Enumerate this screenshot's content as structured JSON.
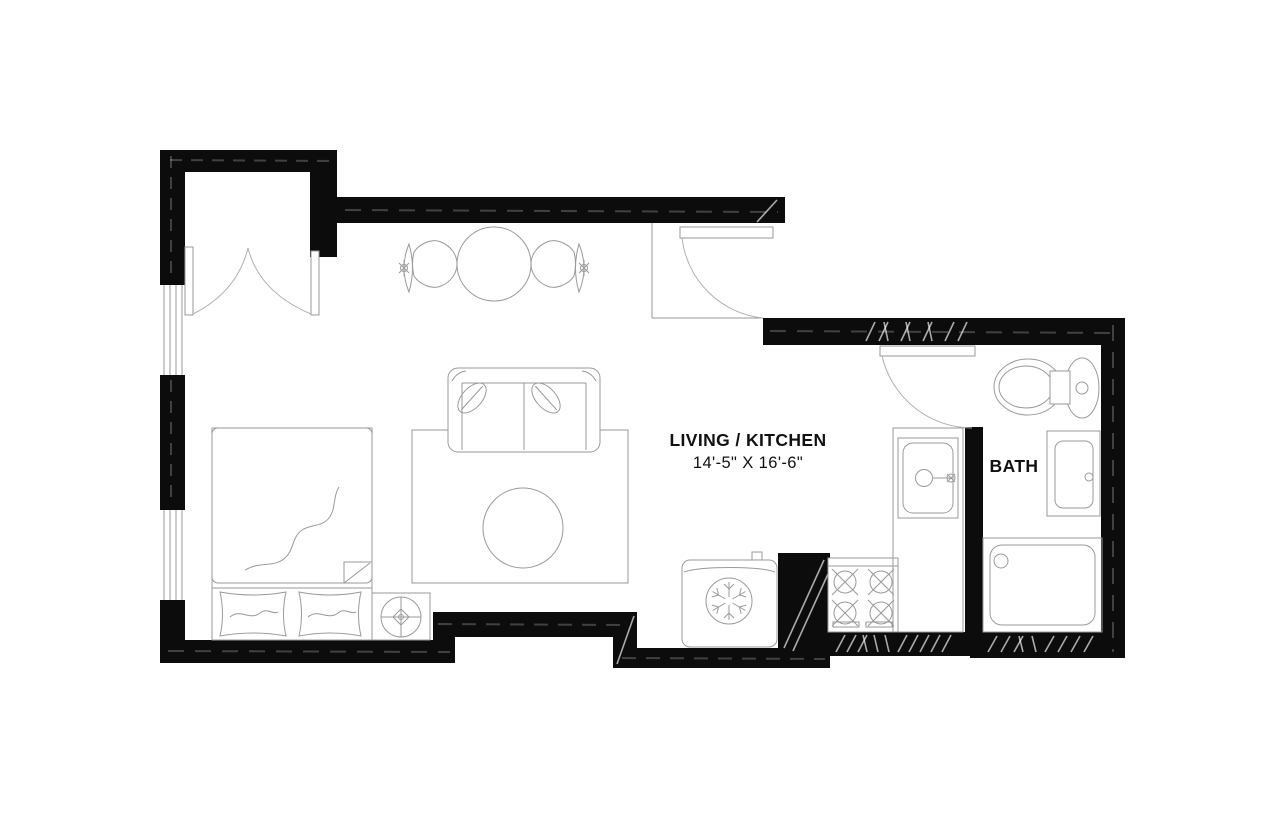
{
  "plan": {
    "rooms": {
      "living_kitchen": {
        "label": "LIVING / KITCHEN",
        "dimensions": "14'-5\" X 16'-6\""
      },
      "bath": {
        "label": "BATH"
      }
    },
    "colors": {
      "wall": "#0c0c0c",
      "furniture_line": "#9a9a9a",
      "background": "#ffffff",
      "text": "#111111"
    },
    "fixtures": [
      "closet-double-door",
      "window",
      "bed",
      "pillow",
      "nightstand",
      "table-lamp",
      "sofa",
      "throw-pillow",
      "rug",
      "coffee-table",
      "dining-table",
      "dining-chair",
      "entry-door",
      "bathroom-door",
      "refrigerator",
      "snowflake",
      "stove",
      "kitchen-sink",
      "toilet",
      "bathroom-vanity",
      "shower"
    ]
  }
}
